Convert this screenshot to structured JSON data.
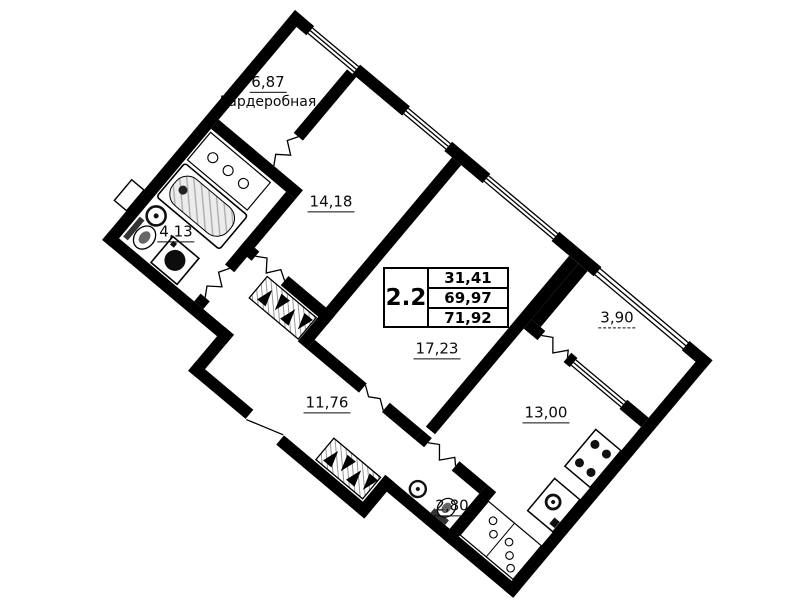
{
  "rooms": {
    "wardrobe": {
      "area": "6,87",
      "name": "Гардеробная"
    },
    "bedroom": {
      "area": "14,18"
    },
    "bathroom": {
      "area": "4,13"
    },
    "living_room": {
      "area": "17,23"
    },
    "hallway": {
      "area": "11,76"
    },
    "kitchen": {
      "area": "13,00"
    },
    "balcony": {
      "area": "3,90"
    },
    "wc": {
      "area": "2,80"
    }
  },
  "info_table": {
    "unit_type": "2.2",
    "rows": [
      "31,41",
      "69,97",
      "71,92"
    ]
  },
  "colors": {
    "wall": "#000000",
    "background": "#ffffff",
    "tub_hatch": "#ececec"
  }
}
